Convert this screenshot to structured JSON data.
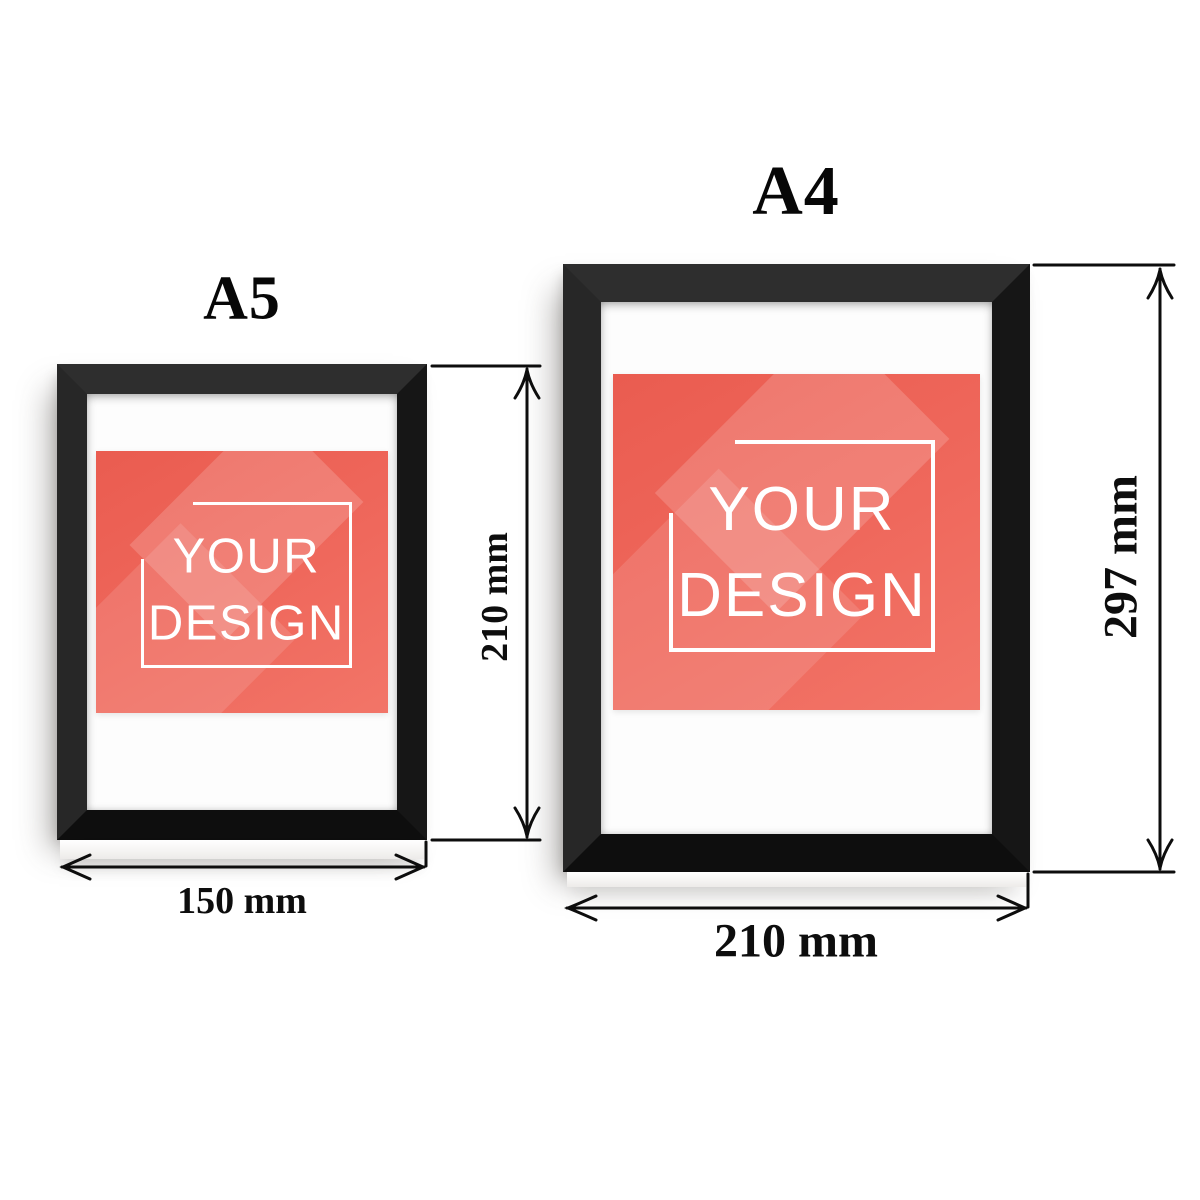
{
  "frames": [
    {
      "name": "A5",
      "width_label": "150 mm",
      "height_label": "210 mm",
      "design_line1": "YOUR",
      "design_line2": "DESIGN"
    },
    {
      "name": "A4",
      "width_label": "210 mm",
      "height_label": "297 mm",
      "design_line1": "YOUR",
      "design_line2": "DESIGN"
    }
  ],
  "colors": {
    "wall": "#ffffff",
    "frame_black": "#1d1d1d",
    "mat_white": "#fdfdfd",
    "artwork_coral": "#ee6357",
    "artwork_facet": "rgba(255,255,255,0.16)",
    "artwork_text": "#ffffff",
    "dimension_ink": "#0d0d0d"
  }
}
